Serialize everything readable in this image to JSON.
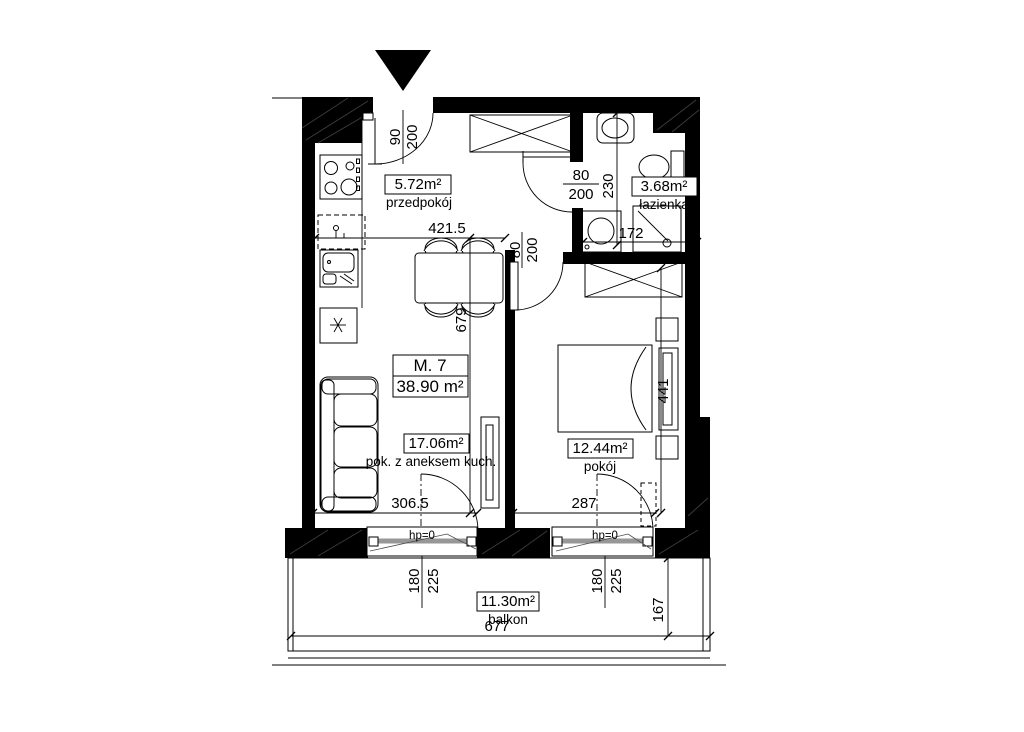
{
  "unit": {
    "code": "M. 7",
    "total_area": "38.90 m²"
  },
  "rooms": {
    "hall": {
      "area": "5.72m²",
      "name": "przedpokój"
    },
    "bathroom": {
      "area": "3.68m²",
      "name": "łazienka"
    },
    "living": {
      "area": "17.06m²",
      "name": "pok. z aneksem kuch."
    },
    "bedroom": {
      "area": "12.44m²",
      "name": "pokój"
    },
    "balcony": {
      "area": "11.30m²",
      "name": "balkon"
    }
  },
  "doors": {
    "entrance": {
      "width": "90",
      "height": "200"
    },
    "bathroom": {
      "width": "80",
      "height": "200"
    },
    "bedroom": {
      "width": "80",
      "height": "200"
    }
  },
  "windows": {
    "living": {
      "width": "180",
      "height": "225",
      "sill": "hp=0"
    },
    "bedroom": {
      "width": "180",
      "height": "225",
      "sill": "hp=0"
    }
  },
  "dims": {
    "living_width": "421.5",
    "living_length": "679",
    "bathroom_length": "230",
    "bathroom_width": "172",
    "bedroom_length": "441",
    "bedroom_width": "287",
    "living_balcony_wall": "306.5",
    "balcony_width": "677",
    "balcony_depth": "167"
  },
  "colors": {
    "walls": "#000000",
    "background": "#ffffff",
    "window_leaf": "#979797"
  }
}
